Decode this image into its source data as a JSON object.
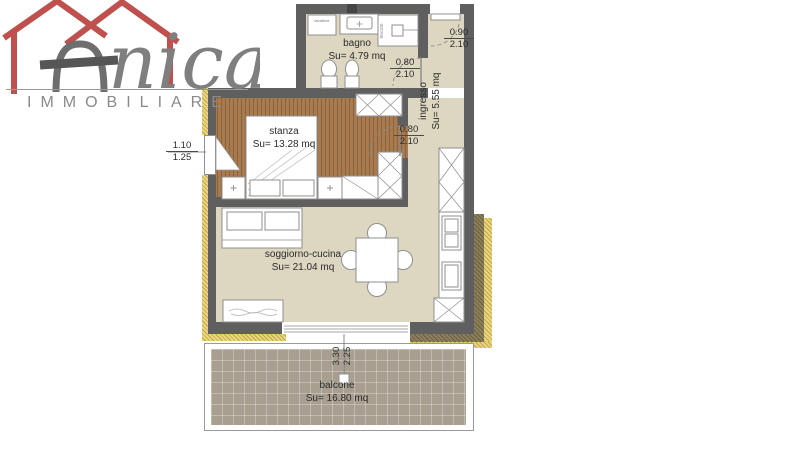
{
  "logo": {
    "brand_suffix": "nica",
    "subtitle": "IMMOBILIARE",
    "colors": {
      "red": "#c0504d",
      "gray": "#7f7f7f"
    }
  },
  "rooms": {
    "bagno": {
      "name": "bagno",
      "area": "Su= 4.79 mq"
    },
    "ingresso": {
      "name": "ingresso",
      "area": "Su= 5.55 mq"
    },
    "stanza": {
      "name": "stanza",
      "area": "Su= 13.28 mq"
    },
    "soggiorno_cucina": {
      "name": "soggiorno-cucina",
      "area": "Su= 21.04 mq"
    },
    "balcone": {
      "name": "balcone",
      "area": "Su= 16.80 mq"
    }
  },
  "dimensions": {
    "entrance_door": {
      "width": "0.90",
      "height": "2.10"
    },
    "bagno_door": {
      "width": "0.80",
      "height": "2.10"
    },
    "stanza_door": {
      "width": "0.80",
      "height": "2.10"
    },
    "stanza_window": {
      "width": "1.10",
      "height": "1.25"
    },
    "balcone_door": {
      "width": "3.30",
      "height": "2.25"
    }
  },
  "labels": {
    "shower_size": "80x100",
    "washer": "lavatrice"
  },
  "colors": {
    "wall": "#5f5f5f",
    "floor": "#ddd6c0",
    "wood": "#a87a50",
    "balcony_floor": "#a99f91",
    "insulation_yellow": "#ebd67c",
    "insulation_olive": "#8c8059"
  }
}
